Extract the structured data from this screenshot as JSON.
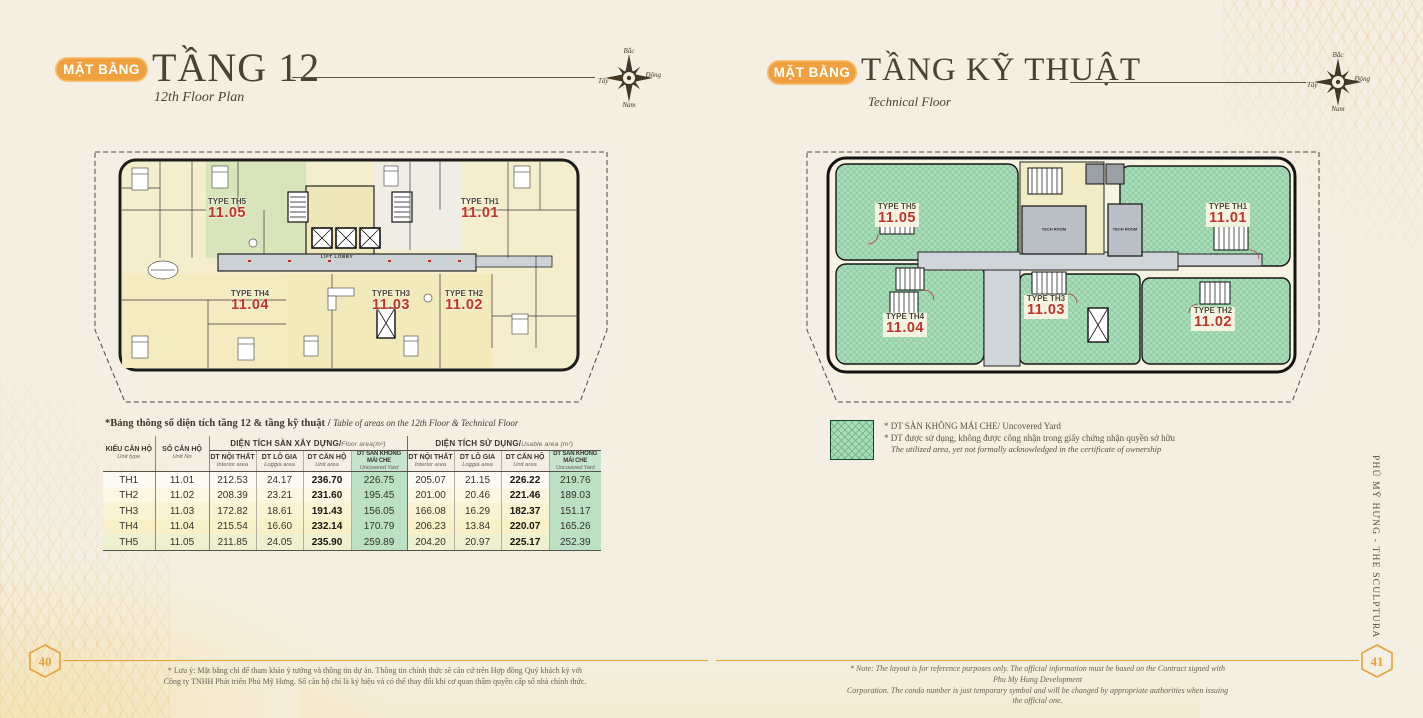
{
  "left_page": {
    "badge": "MẶT BẰNG",
    "title": "TẦNG 12",
    "subtitle": "12th Floor Plan",
    "page_number": "40",
    "footnote_line1": "* Lưu ý: Mặt bằng chỉ để tham khảo ý tưởng và thông tin dự án. Thông tin chính thức sẽ căn cứ trên Hợp đồng Quý khách ký với",
    "footnote_line2": "Công ty TNHH Phát triển Phú Mỹ Hưng. Số căn hộ chỉ là ký hiệu và có thể thay đổi khi cơ quan thẩm quyền cấp số nhà chính thức."
  },
  "right_page": {
    "badge": "MẶT BẰNG",
    "title": "TẦNG KỸ THUẬT",
    "subtitle": "Technical Floor",
    "page_number": "41",
    "note_line1": "* Note: The layout is for reference purposes only. The official information must be based on the Contract signed with Phu My Hung Development",
    "note_line2": "Corporation. The condo number is just temporary symbol and will be changed by appropriate authorities when issuing the official one.",
    "side_text": "PHÚ MỸ HƯNG - THE SCULPTURA"
  },
  "compass": {
    "north": "Bắc",
    "east": "Đông",
    "west": "Tây",
    "south": "Nam"
  },
  "plan12": {
    "lift_lobby": "LIFT LOBBY",
    "units": [
      {
        "type": "TYPE TH5",
        "no": "11.05"
      },
      {
        "type": "TYPE TH1",
        "no": "11.01"
      },
      {
        "type": "TYPE TH4",
        "no": "11.04"
      },
      {
        "type": "TYPE TH3",
        "no": "11.03"
      },
      {
        "type": "TYPE TH2",
        "no": "11.02"
      }
    ]
  },
  "plan_tech": {
    "tech_room": "TECH ROOM",
    "units": [
      {
        "type": "TYPE TH5",
        "no": "11.05"
      },
      {
        "type": "TYPE TH1",
        "no": "11.01"
      },
      {
        "type": "TYPE TH4",
        "no": "11.04"
      },
      {
        "type": "TYPE TH3",
        "no": "11.03"
      },
      {
        "type": "TYPE TH2",
        "no": "11.02"
      }
    ]
  },
  "table": {
    "caption_vi": "*Bảng thông số diện tích tầng 12 & tầng kỹ thuật / ",
    "caption_en": "Table of areas on the 12th Floor & Technical Floor",
    "col1_title": "KIỂU CĂN HỘ",
    "col1_sub": "Unit type",
    "col2_title": "SỐ CĂN HỘ",
    "col2_sub": "Unit No",
    "group1_title": "DIỆN TÍCH SÀN XÂY DỰNG/",
    "group1_sub": "Floor area(m²)",
    "group2_title": "DIỆN TÍCH SỬ DỤNG/",
    "group2_sub": "Usable area (m²)",
    "subcols": [
      {
        "title": "DT NỘI THẤT",
        "sub": "Interior area"
      },
      {
        "title": "DT LÔ GIA",
        "sub": "Loggia area"
      },
      {
        "title": "DT CĂN HỘ",
        "sub": "Unit area"
      },
      {
        "title": "DT SÀN KHÔNG MÁI CHE",
        "sub": "Uncovered Yard"
      }
    ],
    "rows": [
      {
        "type": "TH1",
        "no": "11.01",
        "c": [
          "212.53",
          "24.17",
          "236.70",
          "226.75",
          "205.07",
          "21.15",
          "226.22",
          "219.76"
        ]
      },
      {
        "type": "TH2",
        "no": "11.02",
        "c": [
          "208.39",
          "23.21",
          "231.60",
          "195.45",
          "201.00",
          "20.46",
          "221.46",
          "189.03"
        ]
      },
      {
        "type": "TH3",
        "no": "11.03",
        "c": [
          "172.82",
          "18.61",
          "191.43",
          "156.05",
          "166.08",
          "16.29",
          "182.37",
          "151.17"
        ]
      },
      {
        "type": "TH4",
        "no": "11.04",
        "c": [
          "215.54",
          "16.60",
          "232.14",
          "170.79",
          "206.23",
          "13.84",
          "220.07",
          "165.26"
        ]
      },
      {
        "type": "TH5",
        "no": "11.05",
        "c": [
          "211.85",
          "24.05",
          "235.90",
          "259.89",
          "204.20",
          "20.97",
          "225.17",
          "252.39"
        ]
      }
    ]
  },
  "legend": {
    "line1": "* DT SÀN KHÔNG MÁI CHE/ Uncovered Yard",
    "line2": "* DT được sử dụng, không được công nhận trong giấy chứng nhận quyền sở hữu",
    "line3": "The utilized area, yet not formally acknowledged in the certificate of ownership"
  },
  "colors": {
    "accent_orange": "#EFA03F",
    "unit_number_red": "#C13327",
    "yard_green": "#A9DDB8",
    "table_yard_green": "#BCE0C4",
    "title_brown": "#4C4135"
  }
}
